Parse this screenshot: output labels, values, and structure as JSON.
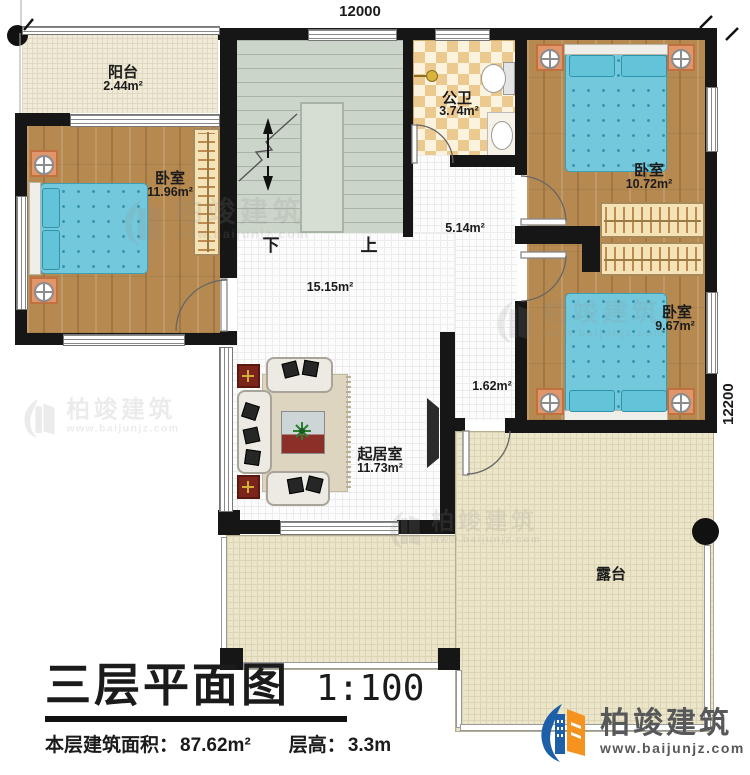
{
  "dimensions": {
    "top": "12000",
    "right": "12200"
  },
  "rooms": {
    "balcony": {
      "name": "阳台",
      "area": "2.44m²"
    },
    "bedroom_left": {
      "name": "卧室",
      "area": "11.96m²"
    },
    "bathroom": {
      "name": "公卫",
      "area": "3.74m²"
    },
    "hallway": {
      "area": "5.14m²"
    },
    "bedroom_top_right": {
      "name": "卧室",
      "area": "10.72m²"
    },
    "hall_center": {
      "area": "15.15m²"
    },
    "bedroom_right": {
      "name": "卧室",
      "area": "9.67m²"
    },
    "corridor": {
      "area": "1.62m²"
    },
    "living": {
      "name": "起居室",
      "area": "11.73m²"
    },
    "terrace": {
      "name": "露台"
    }
  },
  "stairs": {
    "down": "下",
    "up": "上"
  },
  "title_block": {
    "title": "三层平面图",
    "scale": "1:100",
    "floor_area_label": "本层建筑面积：",
    "floor_area_value": "87.62m²",
    "height_label": "层高：",
    "height_value": "3.3m"
  },
  "logo": {
    "name": "柏竣建筑",
    "url": "www.baijunjz.com"
  },
  "watermark": {
    "name": "柏竣建筑",
    "url": "www.baijunjz.com"
  },
  "colors": {
    "wall": "#161616",
    "wood_floor": "#b5894f",
    "bed_blue": "#74c8dc",
    "stair": "#ccd5ca",
    "terrace": "#ebe5c9",
    "bath_tile": "#ecc98f",
    "logo_blue": "#1d5fa8",
    "logo_orange": "#f6921e"
  }
}
